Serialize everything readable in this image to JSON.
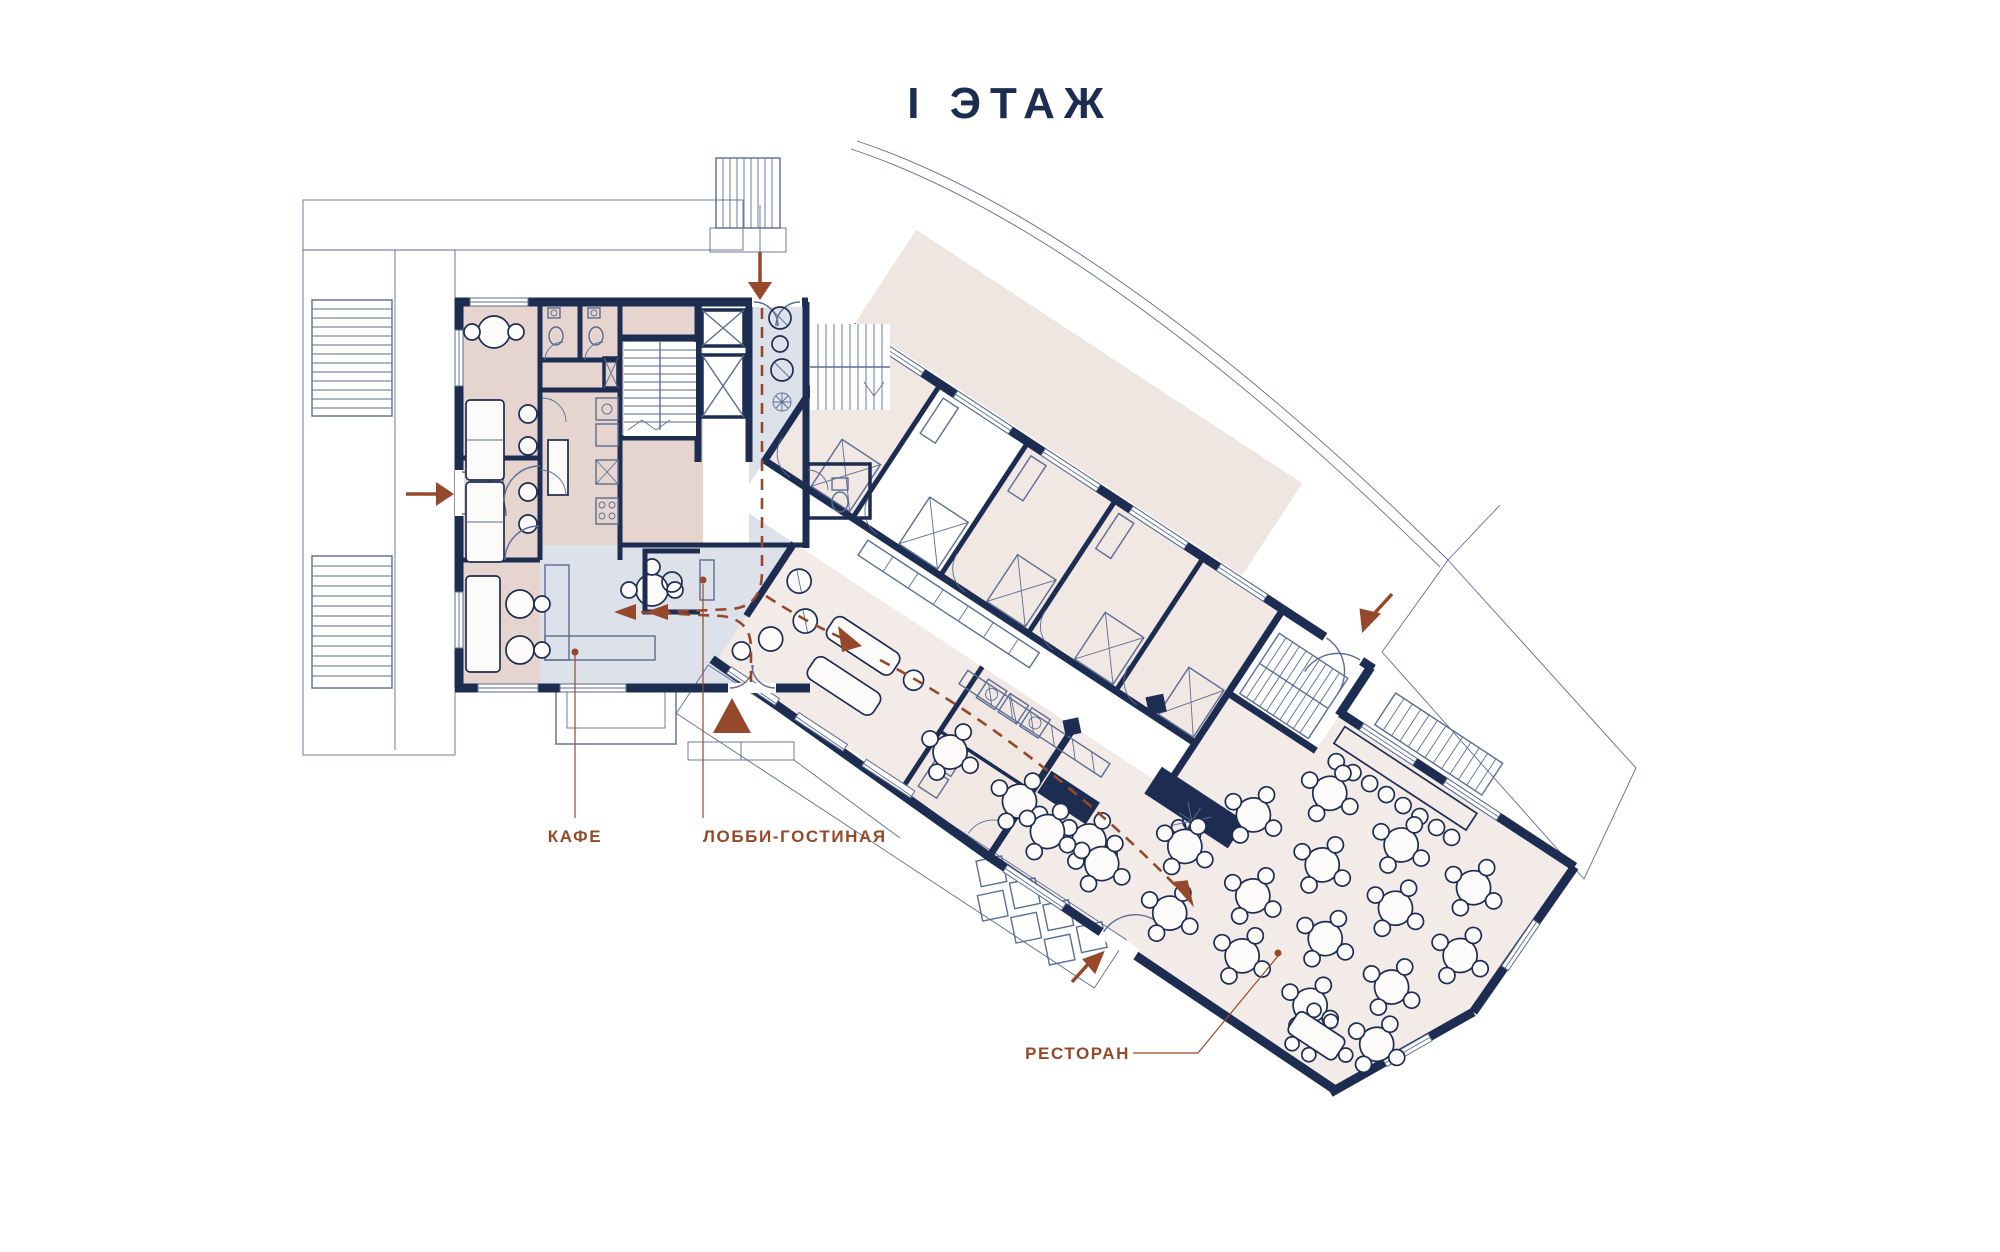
{
  "title": "I  ЭТАЖ",
  "labels": {
    "cafe": "КАФЕ",
    "lobby_lounge": "ЛОББИ-ГОСТИНАЯ",
    "restaurant": "РЕСТОРАН"
  },
  "icons": {
    "entrance_arrows": "entrance-direction-arrow",
    "entrance_marker": "main-entrance-triangle",
    "circulation": "dashed-circulation-path",
    "elevator": "elevator-crossed-box",
    "stairs": "stair-treads"
  },
  "colors": {
    "navy": "#1d2c51",
    "thin": "#5b6d93",
    "rust": "#96492a",
    "cafe": "#e6d5ce",
    "lobby": "#dce1ea",
    "room": "#f1e7e3",
    "restaurant": "#f3ebe8",
    "terrace": "#efe6e1",
    "paper": "#ffffff"
  }
}
